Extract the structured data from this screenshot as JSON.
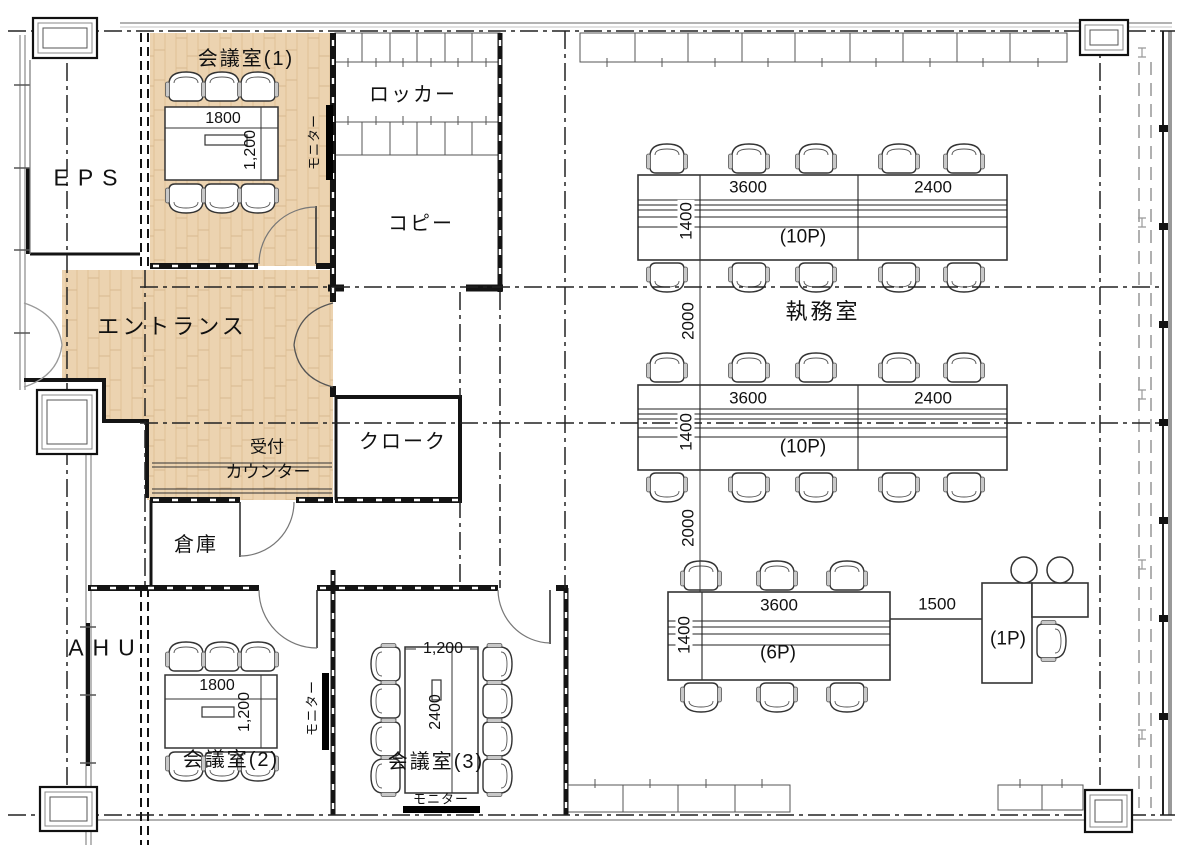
{
  "colors": {
    "wood": "#ecd3b0",
    "wood_grain": "#dfc096",
    "line": "#141414",
    "gray": "#8a8a8a"
  },
  "rooms": {
    "meeting1": {
      "name": "会議室(1)",
      "table_width": "1800",
      "table_depth": "1,200",
      "monitor": "モニター"
    },
    "locker": {
      "name": "ロッカー"
    },
    "copy": {
      "name": "コピー"
    },
    "eps": {
      "name": "EPS"
    },
    "entrance": {
      "name": "エントランス"
    },
    "reception": {
      "name_line1": "受付",
      "name_line2": "カウンター"
    },
    "cloak": {
      "name": "クローク"
    },
    "storage": {
      "name": "倉庫"
    },
    "ahu": {
      "name": "AHU"
    },
    "meeting2": {
      "name": "会議室(2)",
      "table_width": "1800",
      "table_depth": "1,200",
      "monitor": "モニター"
    },
    "meeting3": {
      "name": "会議室(3)",
      "table_width": "1,200",
      "table_depth": "2400",
      "monitor": "モニター"
    },
    "office": {
      "name": "執務室"
    }
  },
  "desk_islands": {
    "island_top": {
      "width_main": "3600",
      "width_side": "2400",
      "depth": "1400",
      "capacity": "(10P)"
    },
    "island_middle": {
      "width_main": "3600",
      "width_side": "2400",
      "depth": "1400",
      "capacity": "(10P)"
    },
    "island_bottom": {
      "width_main": "3600",
      "depth": "1400",
      "capacity": "(6P)",
      "gap_to_manager": "1500"
    },
    "manager_desk": {
      "capacity": "(1P)"
    }
  },
  "aisles": {
    "gap1": "2000",
    "gap2": "2000"
  }
}
